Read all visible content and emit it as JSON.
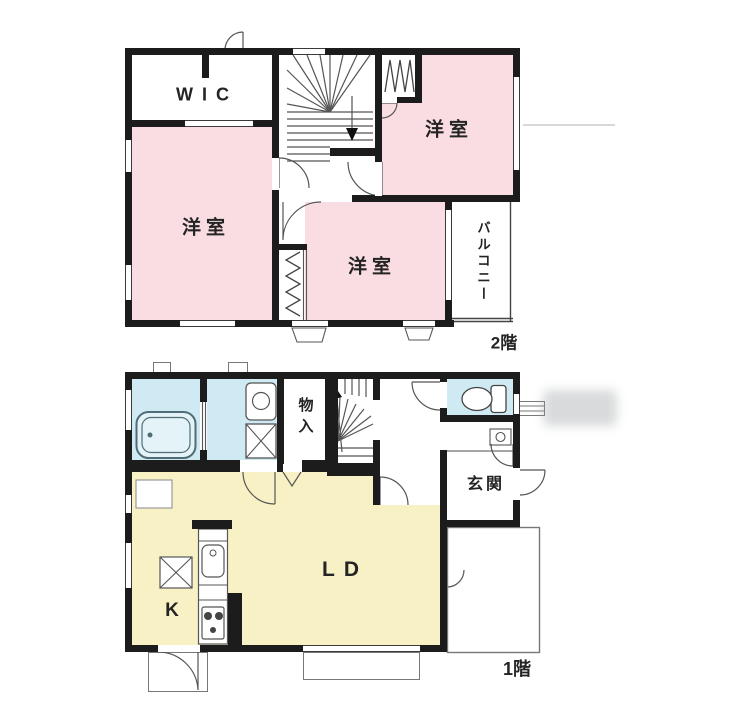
{
  "colors": {
    "wall": "#1c1c1c",
    "bedroom_pink": "#fadde2",
    "ldk_yellow": "#f8f1c6",
    "wet_area_blue": "#cfeaf2",
    "line_gray": "#555555",
    "background": "#ffffff"
  },
  "floor2": {
    "label": "2階",
    "rooms": {
      "wic": "WIC",
      "bedroom_left": "洋室",
      "bedroom_center": "洋室",
      "bedroom_right": "洋室",
      "balcony": "バルコニー"
    }
  },
  "floor1": {
    "label": "1階",
    "rooms": {
      "storage": "物入",
      "entrance": "玄関",
      "living_dining": "LD",
      "kitchen": "K"
    }
  },
  "icons": {
    "stairs-down-arrow": "solid triangle pointing down",
    "stairs-up-arrow": "solid triangle pointing up",
    "bathtub-icon": "rounded rectangle tub",
    "toilet-icon": "ellipse bowl with tank",
    "washbasin-icon": "circle in rounded rectangle",
    "laundry-pan-icon": "square with X",
    "refrigerator-icon": "square with X",
    "kitchen-sink-icon": "rounded rectangle",
    "stove-icon": "rectangle with burner circles",
    "hanger-rod-icon": "zigzag line",
    "door-swing-icon": "quarter-circle arc",
    "window-icon": "double thin line in wall"
  }
}
